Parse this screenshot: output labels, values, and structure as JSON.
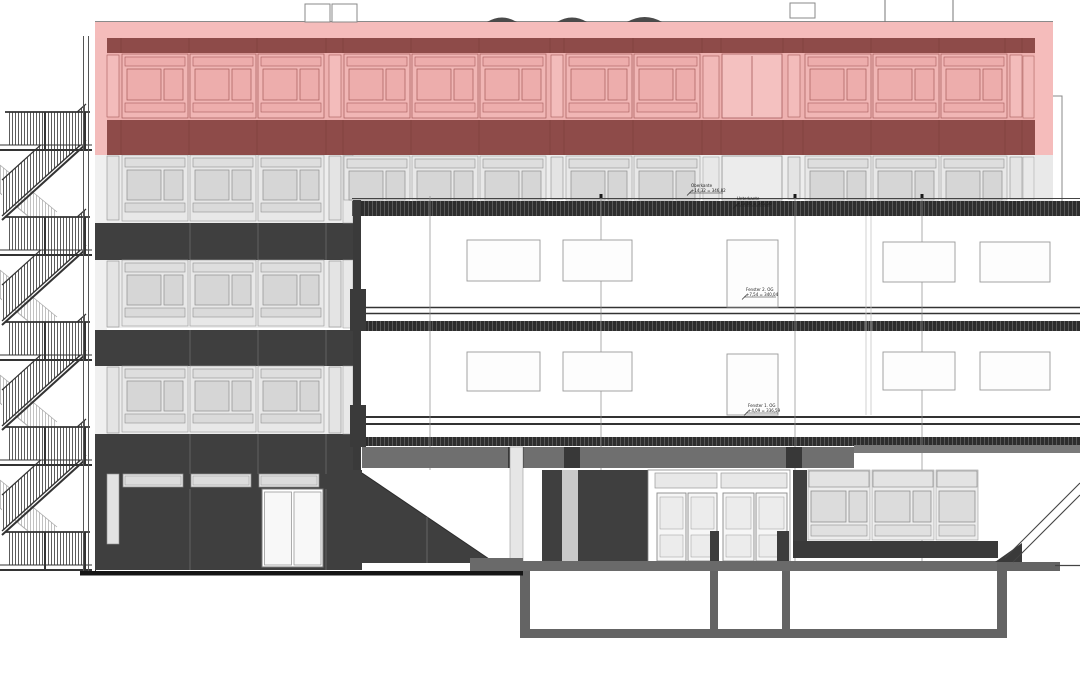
{
  "drawing": {
    "type": "building-section-elevation",
    "highlighted_zone": "top-floor",
    "annotations": {
      "eave": {
        "line1": "Oberkante",
        "line2": "+14,32 = 346,82"
      },
      "slab": {
        "line1": "Unterkante",
        "line2": "+13,06 = 345,56"
      },
      "window2": {
        "line1": "Fenster 2. OG",
        "line2": "+7,54 = 340,04"
      },
      "window1": {
        "line1": "Fenster 1. OG",
        "line2": "+4,09 = 336,59"
      }
    },
    "palette": {
      "highlight_pink": "#f5bcbb",
      "highlight_pink_deep": "#eeb1b0",
      "highlight_maroon": "#8e4b49",
      "facade_dark": "#3f3f3f",
      "panel_light": "#e8e8e8",
      "pane_gray": "#d6d6d6",
      "slab_dark": "#2e2e2e",
      "wall_poche": "#646464",
      "background": "#ffffff"
    }
  }
}
